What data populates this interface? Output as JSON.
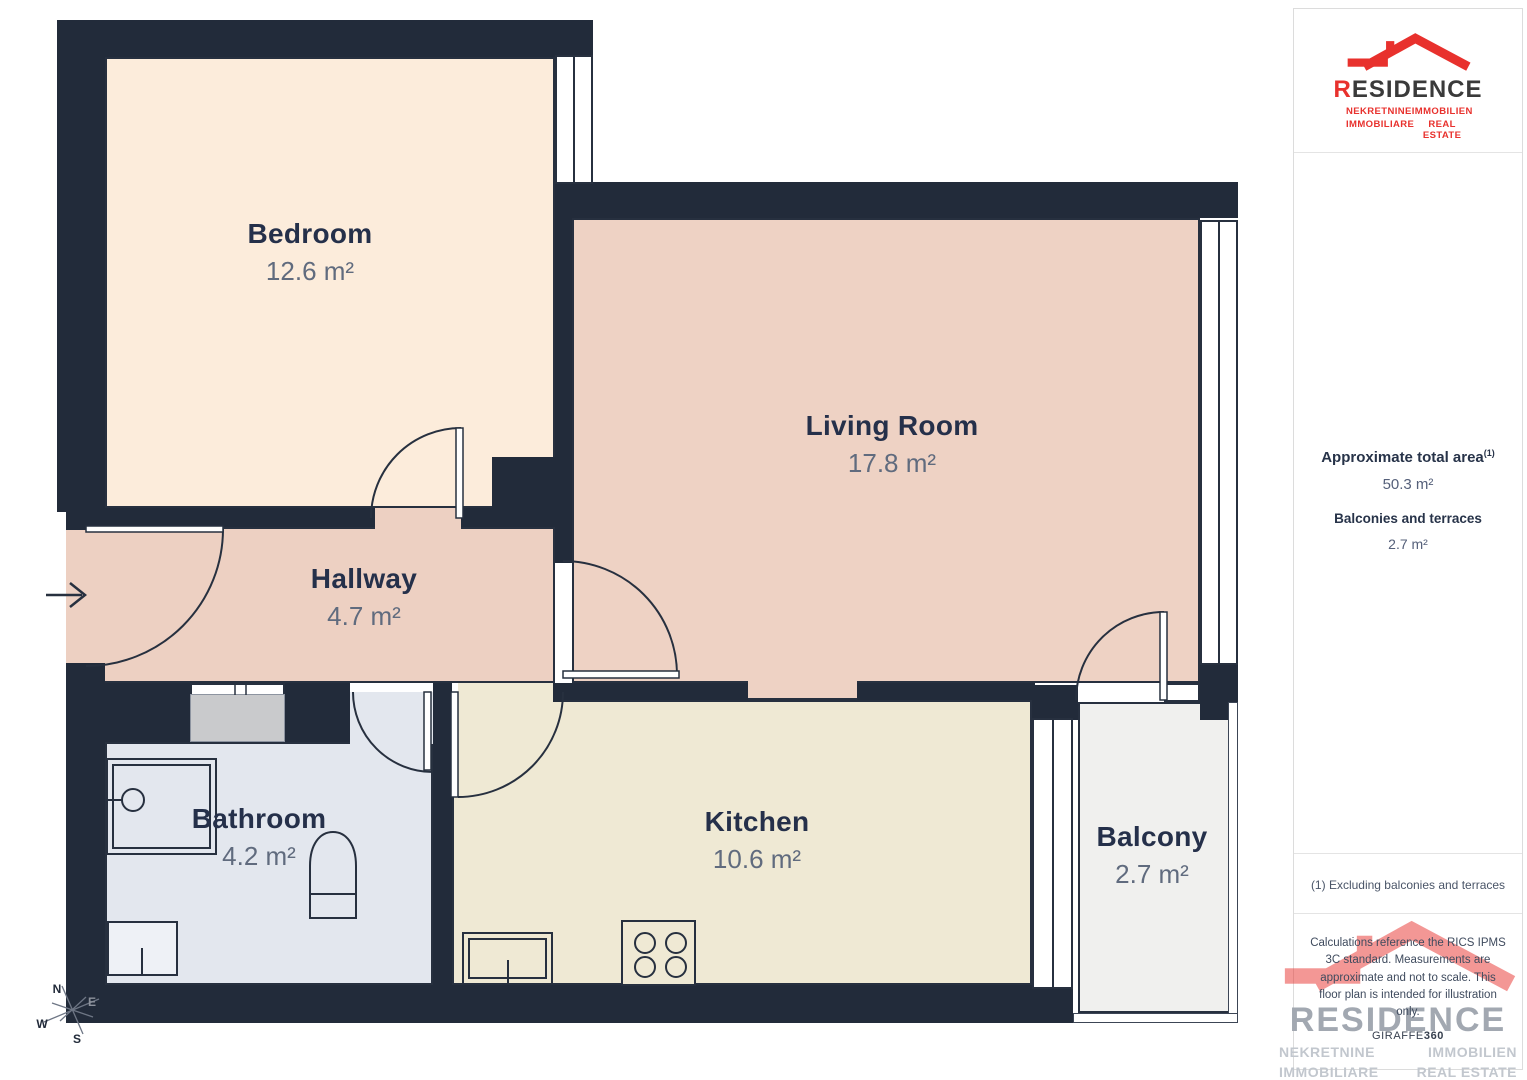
{
  "plan": {
    "rooms": [
      {
        "name": "Bedroom",
        "area": "12.6 m²"
      },
      {
        "name": "Living Room",
        "area": "17.8 m²"
      },
      {
        "name": "Hallway",
        "area": "4.7 m²"
      },
      {
        "name": "Bathroom",
        "area": "4.2 m²"
      },
      {
        "name": "Kitchen",
        "area": "10.6 m²"
      },
      {
        "name": "Balcony",
        "area": "2.7 m²"
      }
    ],
    "compass": {
      "n": "N",
      "e": "E",
      "s": "S",
      "w": "W"
    },
    "icons": [
      "entrance-arrow-icon",
      "compass-icon",
      "shower-icon",
      "toilet-icon",
      "washer-icon",
      "sink-icon",
      "stove-icon",
      "door-arc-icon",
      "window-icon"
    ]
  },
  "sidebar": {
    "logo": {
      "brand_r": "R",
      "brand_rest": "ESIDENCE",
      "taglines": [
        "NEKRETNINE",
        "IMMOBILIEN",
        "IMMOBILIARE",
        "REAL ESTATE"
      ]
    },
    "total_area_label": "Approximate total area",
    "total_area_sup": "(1)",
    "total_area_value": "50.3 m²",
    "balconies_label": "Balconies and terraces",
    "balconies_value": "2.7 m²",
    "footnote": "(1) Excluding balconies and terraces",
    "disclaimer": "Calculations reference the RICS IPMS 3C standard. Measurements are approximate and not to scale. This floor plan is intended for illustration only.",
    "provider_name": "GIRAFFE",
    "provider_suffix": "360"
  },
  "colors": {
    "accent_red": "#e8312d",
    "wall": "#222b3a",
    "bedroom_fill": "#fcecdb",
    "living_fill": "#eed2c4",
    "bathroom_fill": "#e3e7ee",
    "kitchen_fill": "#efe9d4",
    "balcony_fill": "#f0f0ee",
    "vent_gray": "#c9cacc",
    "label": "#25304a",
    "label_muted": "#606b7e"
  }
}
